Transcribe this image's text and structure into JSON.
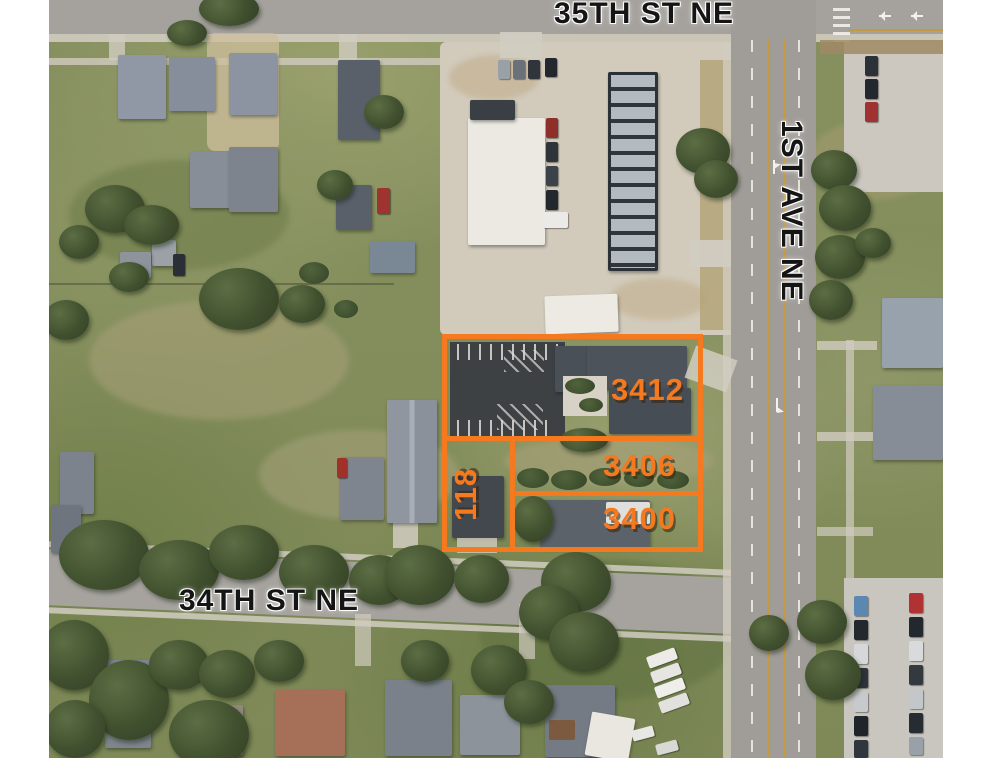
{
  "colors": {
    "overlay_accent": "#f5791f",
    "street_text": "#151515"
  },
  "streets": {
    "north": {
      "label": "35TH ST NE",
      "orientation": "horizontal"
    },
    "east": {
      "label": "1ST AVE NE",
      "orientation": "vertical"
    },
    "south": {
      "label": "34TH ST NE",
      "orientation": "horizontal"
    }
  },
  "parcels": [
    {
      "label": "3412",
      "orientation": "horizontal"
    },
    {
      "label": "3406",
      "orientation": "horizontal"
    },
    {
      "label": "3400",
      "orientation": "horizontal"
    },
    {
      "label": "118",
      "orientation": "vertical"
    }
  ]
}
